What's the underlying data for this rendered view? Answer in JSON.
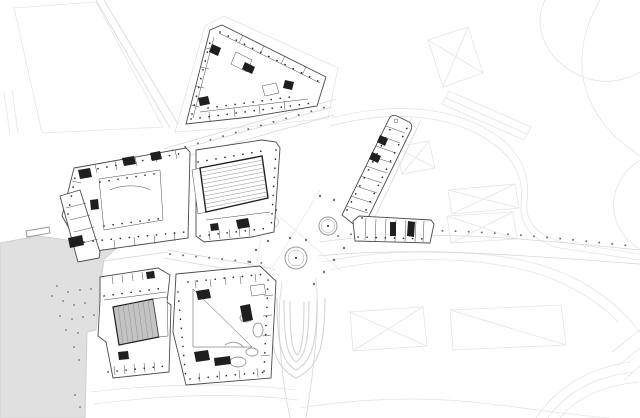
{
  "drawing": {
    "kind": "architectural-site-plan",
    "elements": [
      {
        "id": "water-basin",
        "label": "water basin"
      },
      {
        "id": "pier",
        "label": "pier"
      },
      {
        "id": "context-parcels",
        "label": "faint context parcels and roof envelopes"
      },
      {
        "id": "roads",
        "label": "street network"
      },
      {
        "id": "central-plaza",
        "label": "central plaza with circular features"
      },
      {
        "id": "ramp-structure",
        "label": "nested ramp curves"
      },
      {
        "id": "block-north-triangle",
        "label": "triangular building block north"
      },
      {
        "id": "block-west-courtyard",
        "label": "west block with courtyard"
      },
      {
        "id": "block-concert-hall",
        "label": "central block with hatched auditorium"
      },
      {
        "id": "block-southwest-theater",
        "label": "southwest theatre block with fan seating"
      },
      {
        "id": "block-south-courtyard",
        "label": "south block with triangular courtyard"
      },
      {
        "id": "strip-northeast",
        "label": "narrow strip building northeast"
      },
      {
        "id": "strip-east",
        "label": "narrow strip building east"
      },
      {
        "id": "column-grids",
        "label": "dotted structural column rows"
      },
      {
        "id": "tree-rows",
        "label": "street tree dots"
      }
    ]
  },
  "palette": {
    "background": "#ffffff",
    "water": "#e0e0e0",
    "water_edge": "#cfcfcf",
    "context_line": "#e4e4e4",
    "road_line": "#d7d7d7",
    "ramp_line": "#d0d0d0",
    "building_stroke": "#4a4a4a",
    "building_fill": "#ffffff",
    "wall_dark": "#1f1f1f",
    "column_dot": "#2a2a2a",
    "hatch_line": "#8f8f8f",
    "seating_fill": "#c3c3c3",
    "tree_dot": "#6e6e6e",
    "plaza_line": "#9a9a9a",
    "paving_line": "#ededed",
    "mooring_dot": "#8a8a8a"
  }
}
